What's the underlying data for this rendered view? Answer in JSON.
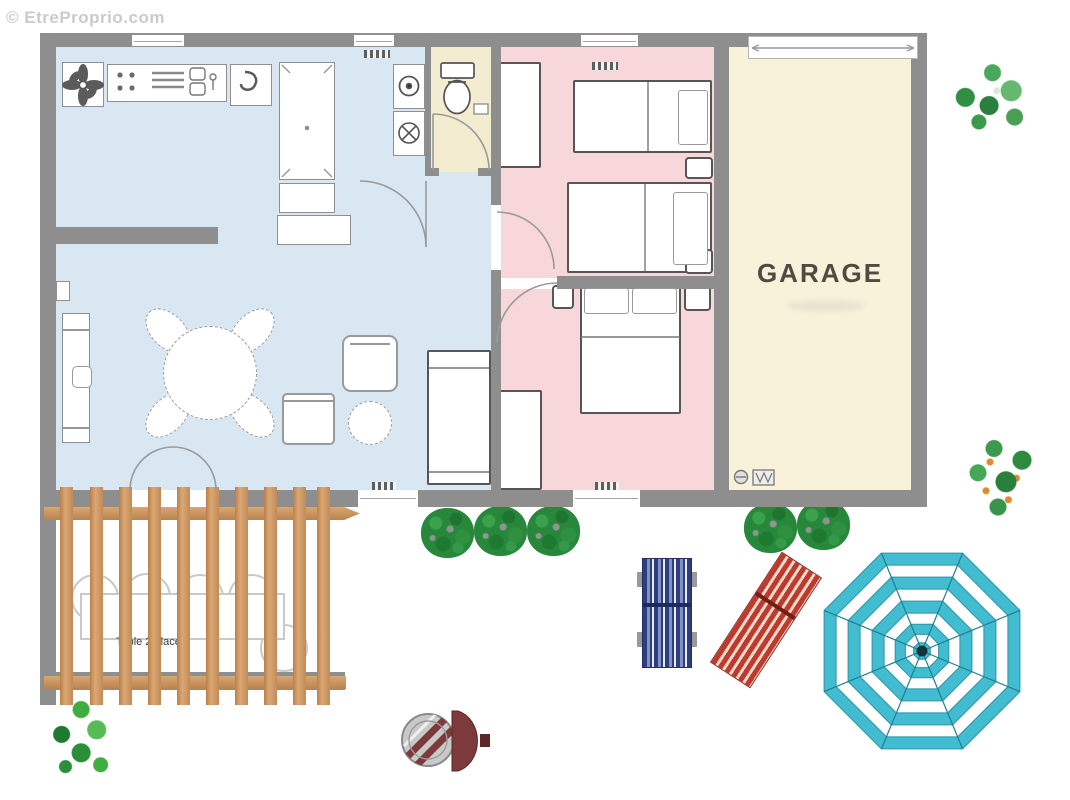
{
  "watermark": {
    "text": "© EtreProprio.com"
  },
  "garage": {
    "label": "GARAGE"
  },
  "terrace": {
    "table_label": "Table 2 places"
  },
  "icons": {
    "cooktop-fan-icon": "four-petal fan glyph",
    "washing-machine-icon": "circle with dot",
    "dryer-icon": "circle with X",
    "toilet-icon": "tank + oval bowl",
    "water-heater-icon": "small circle",
    "utility-box-icon": "small box with W",
    "tree-icon": "speckled foliage cluster",
    "bush-icon": "round speckled shrub",
    "umbrella-icon": "octagonal striped parasol",
    "bbq-icon": "round grill with lid"
  },
  "colors": {
    "wall_gray": "#8e8e8e",
    "living_blue": "#d9e7f2",
    "bedroom_pink": "#f7d7da",
    "bathroom_cream": "#f4ecd0",
    "garage_cream": "#f8f2da",
    "pergola_wood": "#c99261",
    "umbrella_teal": "#41bcd0",
    "lounger_blue": "#2e3e7d",
    "lounger_red": "#bf3a2d",
    "bush_green": "#27873a",
    "bbq_lid_red": "#7c3a3a"
  }
}
